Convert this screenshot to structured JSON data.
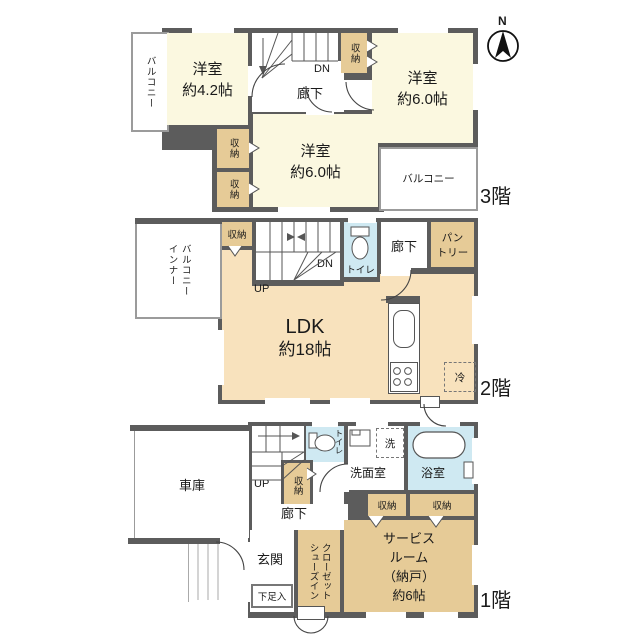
{
  "colors": {
    "wall": "#5c5c5c",
    "room_cream": "#fbf8e0",
    "storage_tan": "#e6cb97",
    "ldk_peach": "#f8e2bd",
    "wet_blue": "#cfe9f2"
  },
  "compass": {
    "north": "N"
  },
  "floor3": {
    "floor_label": "3階",
    "balcony_left": "バルコニー",
    "room_a_name": "洋室",
    "room_a_size": "約4.2帖",
    "storage_top": "収納",
    "dn": "DN",
    "hallway": "廊下",
    "room_b_name": "洋室",
    "room_b_size": "約6.0帖",
    "storage_mid1": "収納",
    "storage_mid2": "収納",
    "room_c_name": "洋室",
    "room_c_size": "約6.0帖",
    "balcony_right": "バルコニー"
  },
  "floor2": {
    "floor_label": "2階",
    "inner_balcony_col1": "インナー",
    "inner_balcony_col2": "バルコニー",
    "storage": "収納",
    "up": "UP",
    "dn": "DN",
    "toilet": "トイレ",
    "hallway": "廊下",
    "pantry_line1": "パン",
    "pantry_line2": "トリー",
    "ldk_name": "LDK",
    "ldk_size": "約18帖",
    "fridge": "冷"
  },
  "floor1": {
    "floor_label": "1階",
    "garage": "車庫",
    "up": "UP",
    "storage_stair": "収納",
    "toilet": "トイレ",
    "washer": "洗",
    "washroom": "洗面室",
    "bathroom": "浴室",
    "storage_a": "収納",
    "storage_b": "収納",
    "hallway": "廊下",
    "entrance": "玄関",
    "shoe_box": "下足入",
    "sic_col1": "シューズイン",
    "sic_col2": "クローゼット",
    "service_line1": "サービス",
    "service_line2": "ルーム",
    "service_line3": "（納戸）",
    "service_line4": "約6帖"
  }
}
